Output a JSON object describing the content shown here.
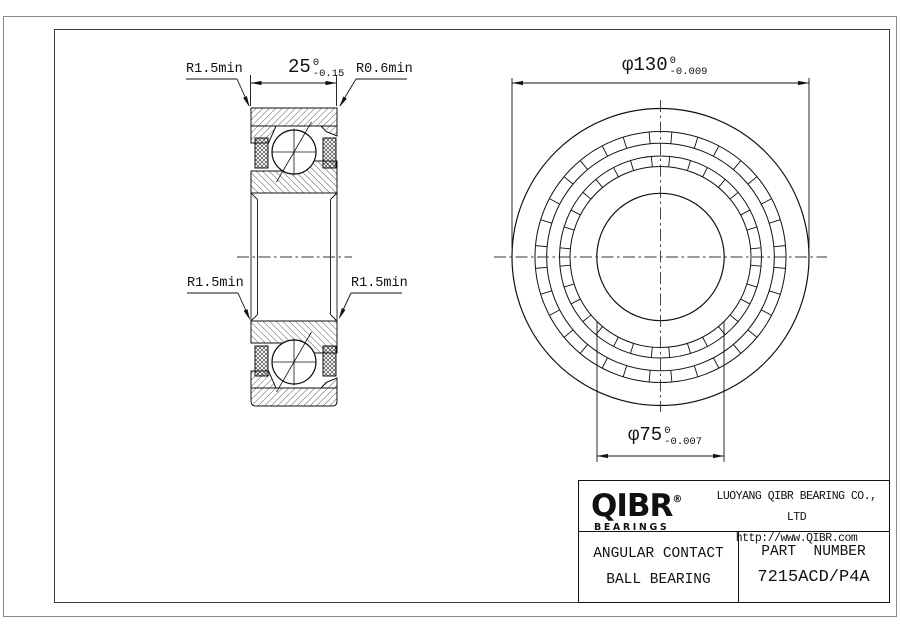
{
  "page": {
    "dimensions": {
      "width": {
        "value": "25",
        "tol_upper": "0",
        "tol_lower": "-0.15"
      },
      "outer_diameter": {
        "symbol": "φ",
        "value": "130",
        "tol_upper": "0",
        "tol_lower": "-0.009"
      },
      "bore_diameter": {
        "symbol": "φ",
        "value": "75",
        "tol_upper": "0",
        "tol_lower": "-0.007"
      },
      "radius_top_left": "R1.5min",
      "radius_top_right": "R0.6min",
      "radius_mid_left": "R1.5min",
      "radius_mid_right": "R1.5min"
    },
    "title_block": {
      "logo_text": "QIBR",
      "logo_registered": "®",
      "logo_subtitle": "BEARINGS",
      "company_name": "LUOYANG QIBR BEARING CO., LTD",
      "website": "http://www.QIBR.com",
      "product_line1": "ANGULAR CONTACT",
      "product_line2": "BALL BEARING",
      "part_number_label": "PART  NUMBER",
      "part_number": "7215ACD/P4A"
    }
  }
}
